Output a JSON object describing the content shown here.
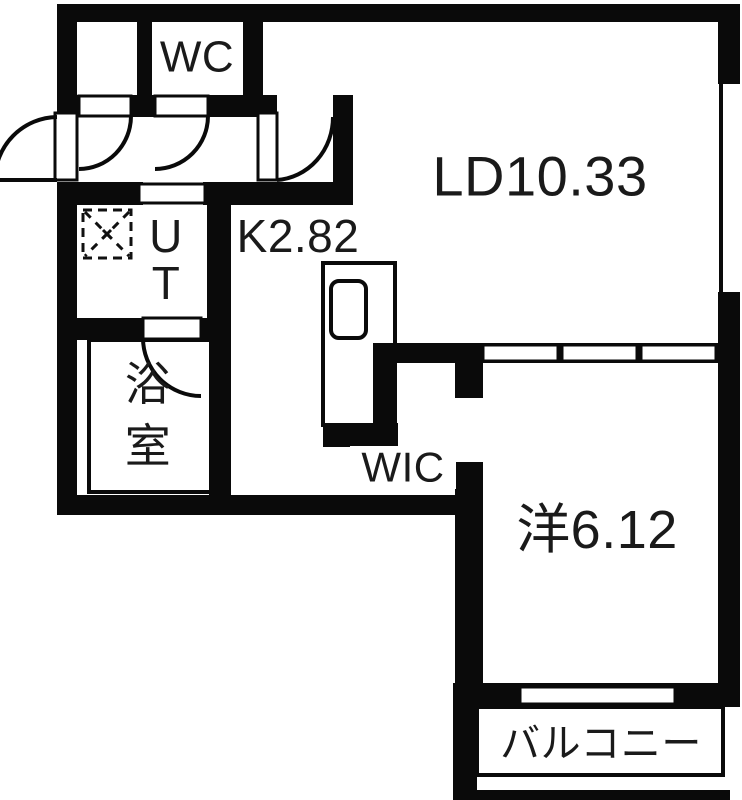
{
  "plan_type": "apartment-floor-plan",
  "labels": {
    "wc": "WC",
    "living_dining": "LD10.33",
    "kitchen": "K2.82",
    "utility": "UT",
    "bath": "浴室",
    "wic": "WIC",
    "western_room": "洋6.12",
    "balcony": "バルコニー"
  },
  "rooms": [
    {
      "id": "wc",
      "label": "WC"
    },
    {
      "id": "living_dining",
      "label": "LD10.33",
      "area_mats": "10.33"
    },
    {
      "id": "kitchen",
      "label": "K2.82",
      "area_mats": "2.82"
    },
    {
      "id": "utility",
      "label": "UT"
    },
    {
      "id": "bath",
      "label": "浴室"
    },
    {
      "id": "wic",
      "label": "WIC"
    },
    {
      "id": "western_room",
      "label": "洋6.12",
      "area_mats": "6.12"
    },
    {
      "id": "balcony",
      "label": "バルコニー"
    }
  ],
  "colors": {
    "wall": "#0a0a0a",
    "floor": "#ffffff",
    "text": "#1a1a1a"
  },
  "symbols": {
    "door_swing": "quarter-circle-arc",
    "entry_door": "outward-swing-arc",
    "sliding_door": "white-leaf-rect",
    "window": "white-gap-in-wall",
    "washer_pan": "dashed-square-with-x",
    "kitchen_sink": "rounded-rect",
    "balcony_rail": "thin-outline-rect"
  }
}
